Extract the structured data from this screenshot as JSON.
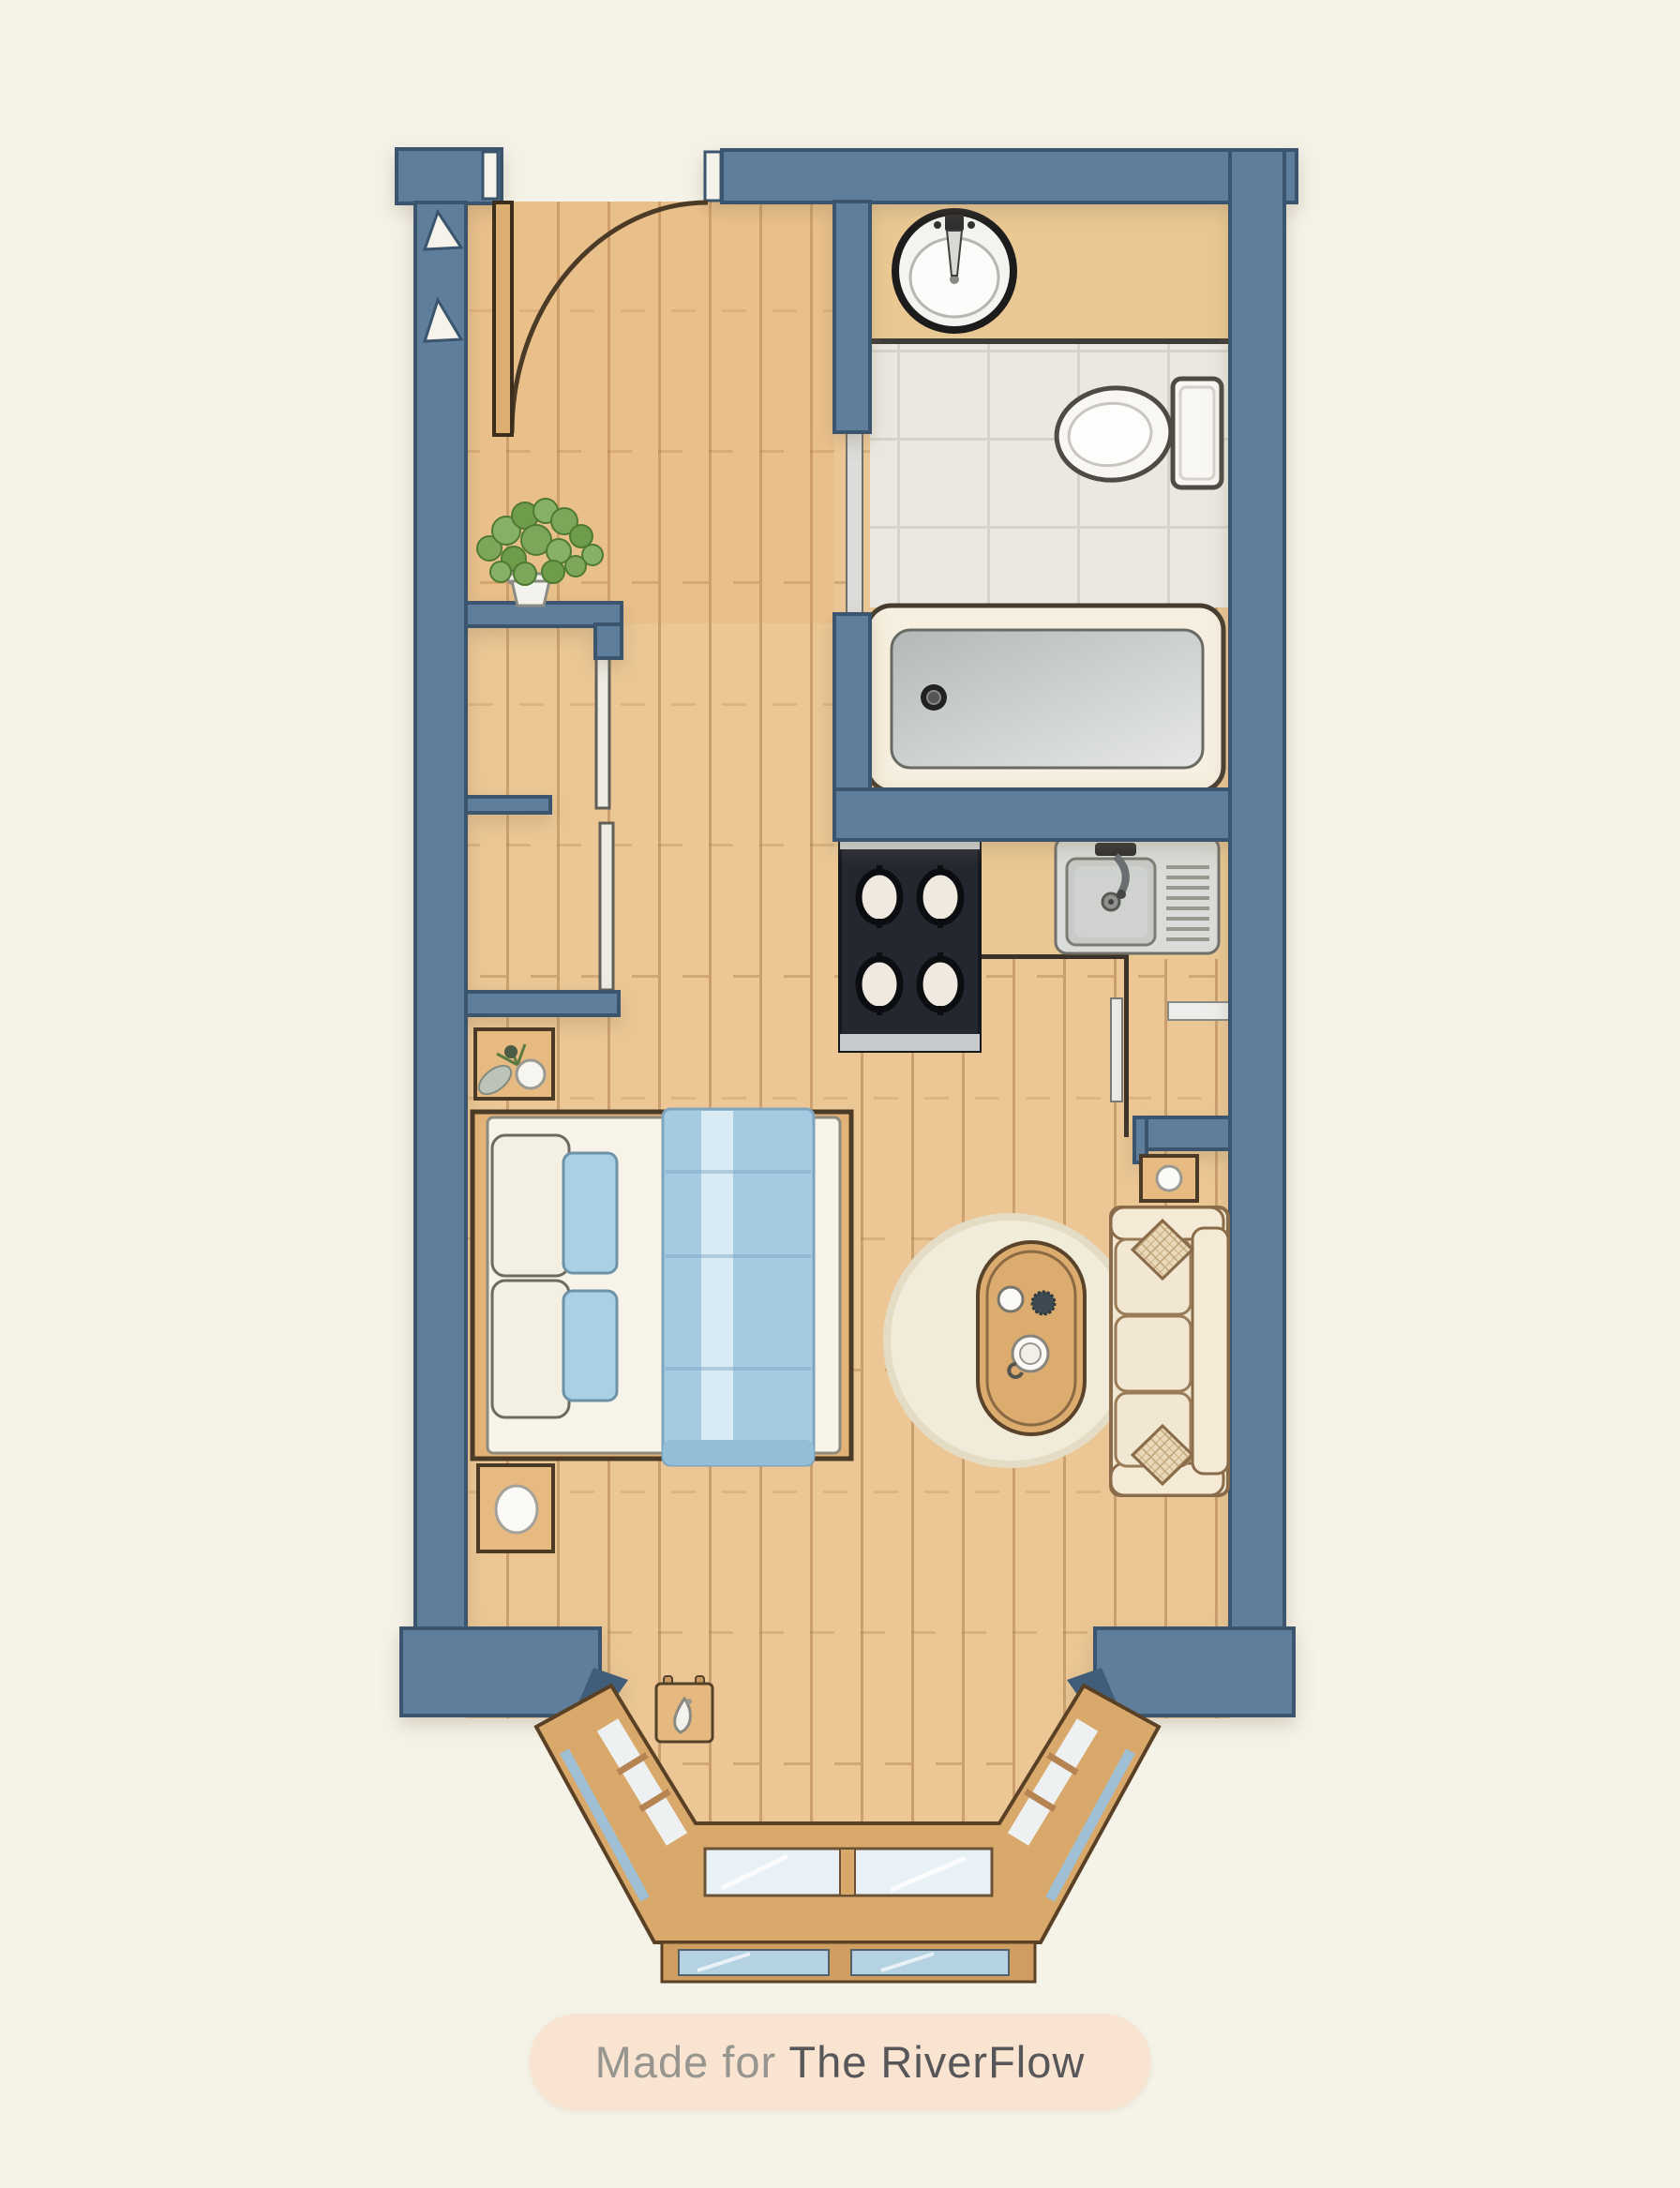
{
  "caption": {
    "prefix": "Made for ",
    "brand": "The RiverFlow"
  },
  "palette": {
    "background": "#f5f2e8",
    "wall_fill": "#5e7e9b",
    "wall_outline": "#3a556e",
    "wall_dark_accent": "#3f5d79",
    "floor_wood": "#ecc795",
    "furniture_wood": "#e3b77e",
    "counter_wood": "#eac893",
    "textile_blue": "#a6cce4",
    "textile_blue_light": "#d6e9f3",
    "tile": "#ebe8e1",
    "tub_rim_cream": "#f7efdf",
    "tub_interior_grey": "#c9cdcb",
    "stove_black": "#232830",
    "steel": "#dadcd9",
    "sofa_cream": "#f0e5cf",
    "rug_cream": "#f1ebd9",
    "plant_green": "#7da65a",
    "caption_pill": "#f9e4d1",
    "caption_text": "#97958f",
    "caption_brand_text": "#575759"
  },
  "plan": {
    "type": "studio-apartment-floor-plan",
    "rooms": [
      {
        "name": "entry-hall",
        "fixtures": [
          "hinged-entry-door-with-swing-arc",
          "wall-marker-triangles"
        ]
      },
      {
        "name": "bathroom",
        "fixtures": [
          "wood-vanity-counter",
          "round-basin-sink",
          "toilet",
          "bathtub-with-drain",
          "pocket-sliding-door",
          "tiled-floor"
        ]
      },
      {
        "name": "kitchenette",
        "fixtures": [
          "four-burner-cooktop",
          "steel-sink-with-drainboard",
          "wood-counter",
          "tall-cabinet-sliding-door",
          "wall-shelf"
        ]
      },
      {
        "name": "closet-wall",
        "fixtures": [
          "upper-sliding-closet",
          "lower-sliding-closet",
          "potted-plant-on-shelf"
        ]
      },
      {
        "name": "sleeping-area",
        "furniture": [
          "double-bed-with-blue-throw",
          "white-pillows",
          "blue-pillows",
          "nightstand-with-plant",
          "nightstand-with-lamp"
        ]
      },
      {
        "name": "living-area",
        "furniture": [
          "three-seat-sofa",
          "diamond-throw-pillows",
          "oval-coffee-table",
          "cups-on-table",
          "round-rug",
          "side-table-with-lamp"
        ]
      },
      {
        "name": "bay-window",
        "fixtures": [
          "angled-glazing-left",
          "center-glazing",
          "angled-glazing-right",
          "outer-glazing-row",
          "wall-hook-board"
        ]
      }
    ],
    "door": {
      "type": "hinged-entry-door",
      "swing": "quarter-arc"
    }
  }
}
